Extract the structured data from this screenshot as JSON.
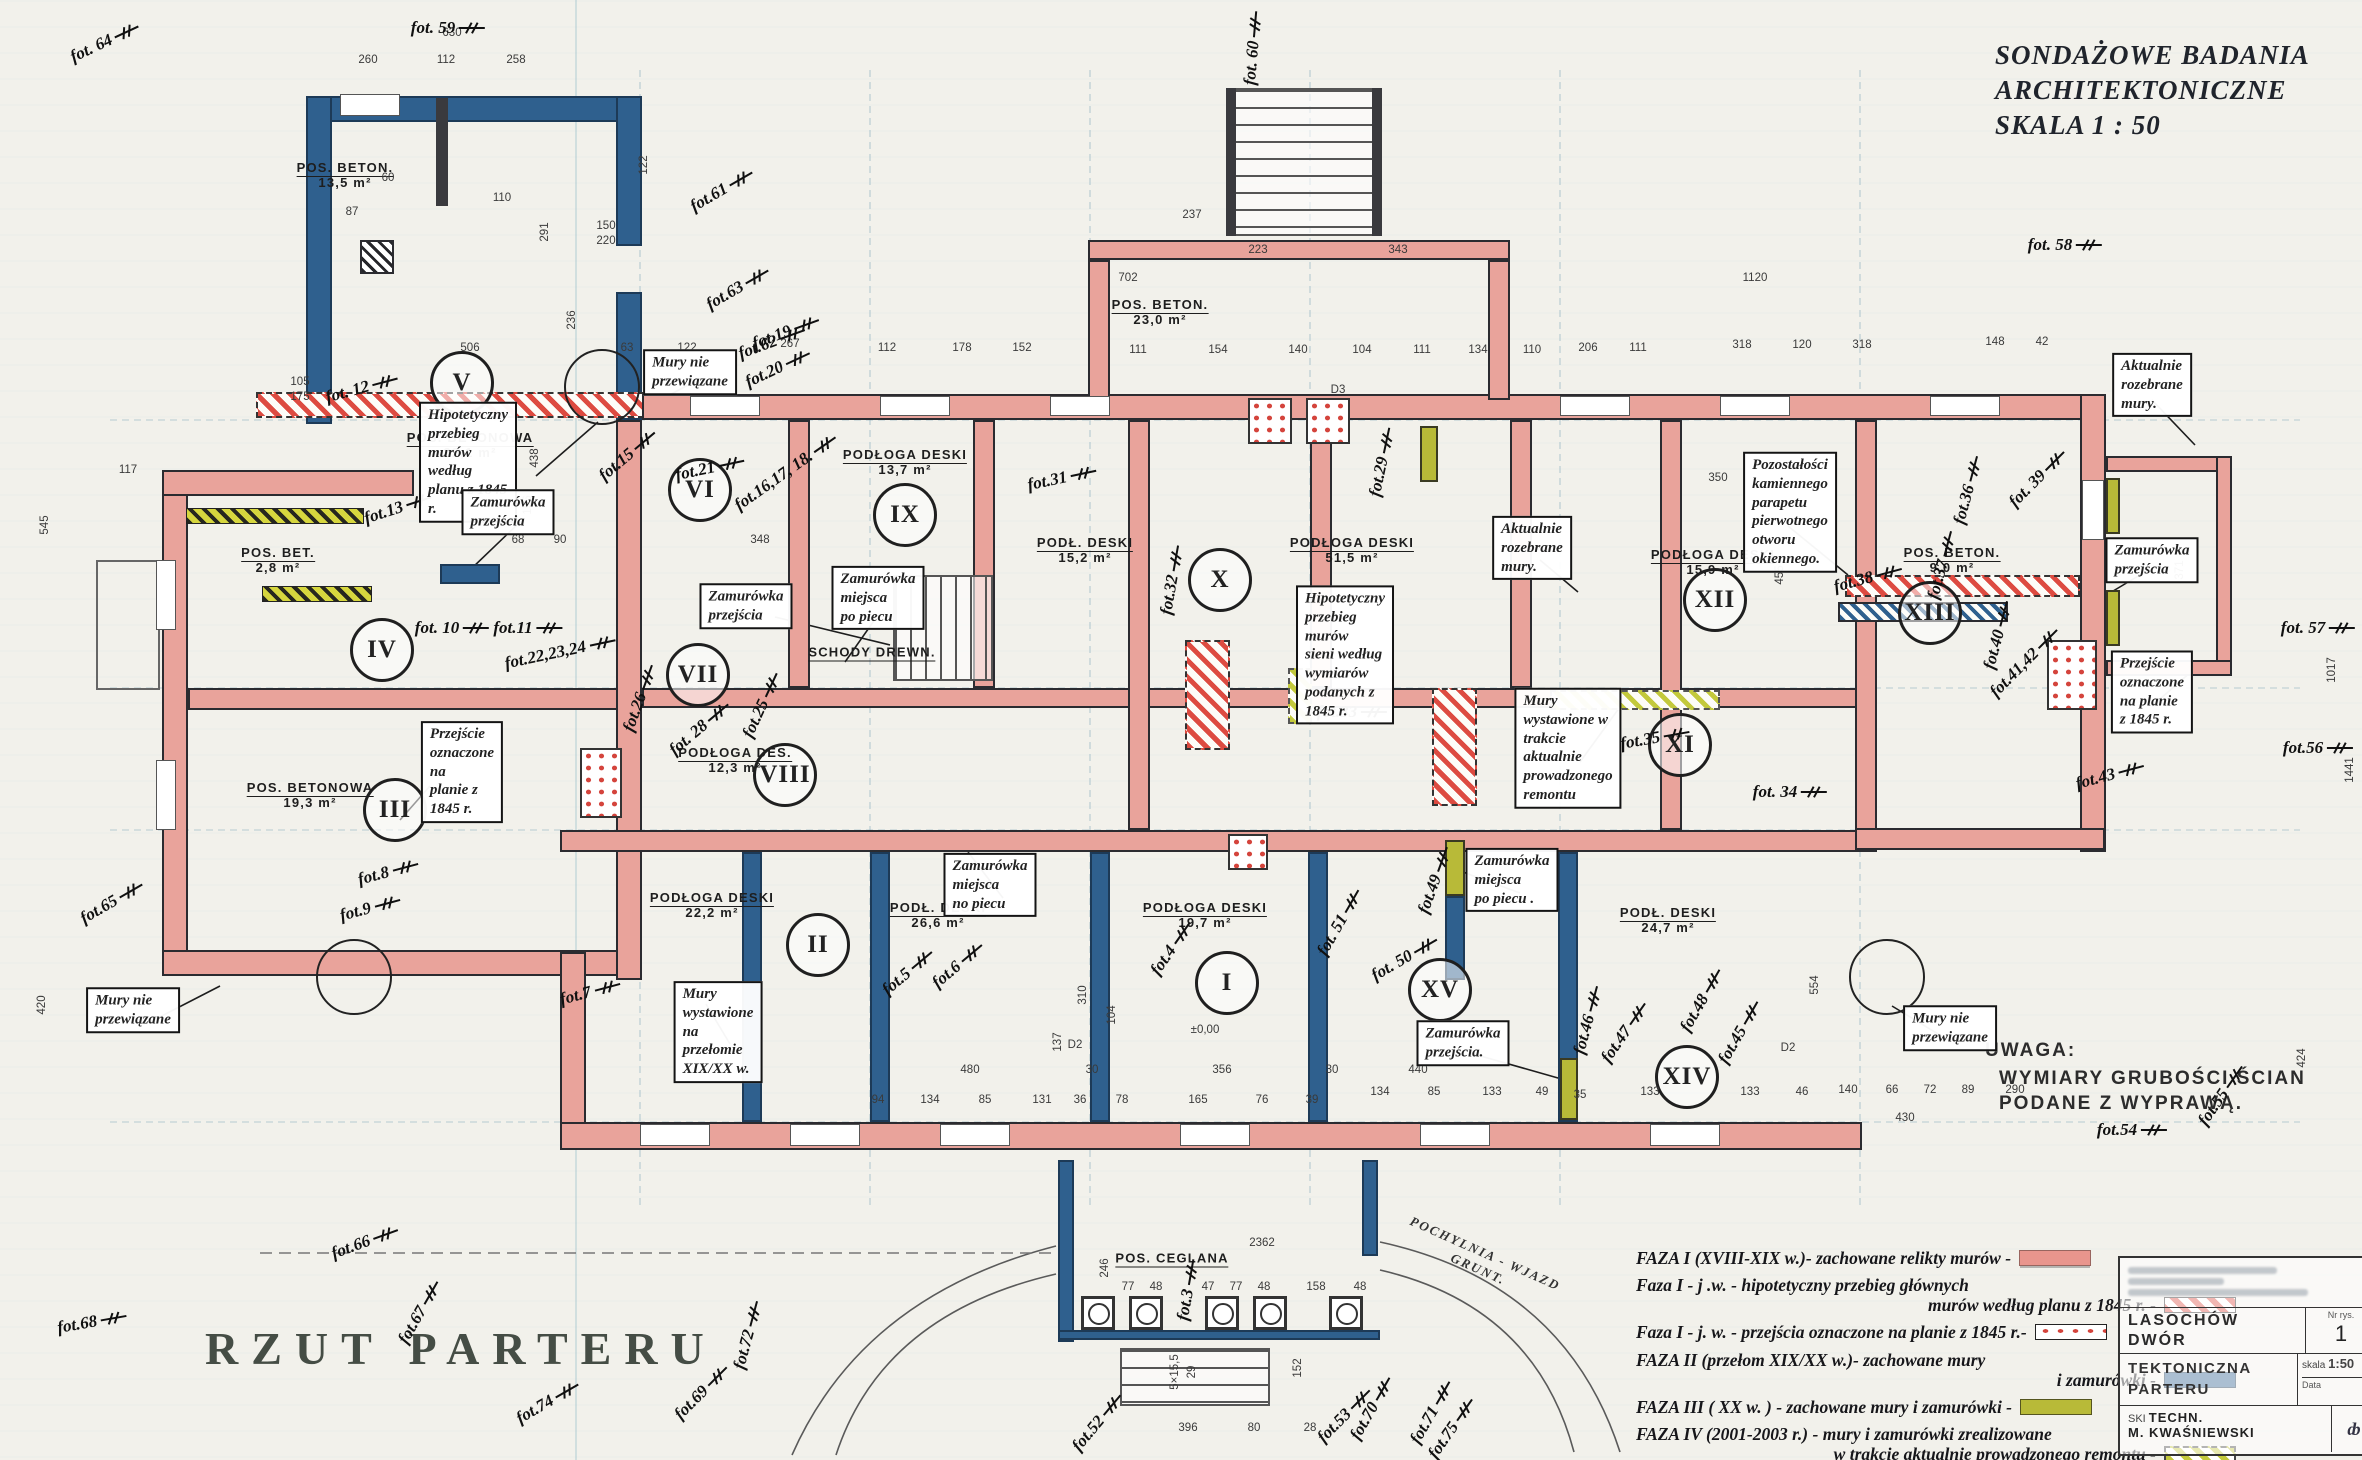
{
  "header": {
    "line1": "SONDAŻOWE  BADANIA",
    "line2": "ARCHITEKTONICZNE",
    "line3": "SKALA   1 : 50"
  },
  "drawing_title": "RZUT  PARTERU",
  "note": {
    "title": "UWAGA:",
    "line1": "WYMIARY GRUBOŚCI ŚCIAN",
    "line2": "PODANE Z WYPRAWĄ."
  },
  "arc_label": {
    "line1": "POCHYLNIA - WJAZD",
    "line2": "GRUNT."
  },
  "colors": {
    "faza1_pink": "#e9a39b",
    "faza1_hatch_red": "#dd4b41",
    "faza1_dots_red": "#d4443c",
    "faza2_blue": "#2f608e",
    "faza3_olive": "#b8ba38",
    "faza4_yellowgreen": "#c3c93c",
    "ink": "#2b2b30",
    "paper": "#f2f1eb"
  },
  "legend": {
    "items": [
      {
        "lines": [
          "FAZA I  (XVIII-XIX w.)- zachowane relikty murów -"
        ],
        "swatch": "sw-f1",
        "name": "faza-1"
      },
      {
        "lines": [
          "Faza I  -  j .w.  -  hipotetyczny  przebieg  głównych",
          "murów  według   planu  z 1845 r. -"
        ],
        "swatch": "sw-f1h",
        "name": "faza-1-hipotetyczny"
      },
      {
        "lines": [
          "Faza I - j. w. - przejścia oznaczone na planie z 1845 r.-"
        ],
        "swatch": "sw-f1d",
        "name": "faza-1-przejscia"
      },
      {
        "lines": [
          "FAZA II (przełom XIX/XX w.)- zachowane mury",
          "i  zamurówki -"
        ],
        "swatch": "sw-f2",
        "name": "faza-2"
      },
      {
        "lines": [
          "FAZA III ( XX w. ) - zachowane mury  i zamurówki -"
        ],
        "swatch": "sw-f3",
        "name": "faza-3"
      },
      {
        "lines": [
          "FAZA IV (2001-2003 r.) - mury i zamurówki zrealizowane",
          "w  trakcie  aktualnie prowadzonego remontu  -"
        ],
        "swatch": "sw-f4",
        "name": "faza-4"
      },
      {
        "lines": [
          "Faza - j. w - rozbiórki w trakcie  realizowanego remontu  -"
        ],
        "swatch": "sw-rz",
        "name": "faza-rozbiorki"
      }
    ]
  },
  "rooms": [
    {
      "numeral": "I",
      "x": 1227,
      "y": 983
    },
    {
      "numeral": "II",
      "x": 818,
      "y": 945
    },
    {
      "numeral": "III",
      "x": 395,
      "y": 810
    },
    {
      "numeral": "IV",
      "x": 382,
      "y": 650
    },
    {
      "numeral": "V",
      "x": 462,
      "y": 383
    },
    {
      "numeral": "VI",
      "x": 700,
      "y": 490
    },
    {
      "numeral": "VII",
      "x": 698,
      "y": 675
    },
    {
      "numeral": "VIII",
      "x": 785,
      "y": 775
    },
    {
      "numeral": "IX",
      "x": 905,
      "y": 515
    },
    {
      "numeral": "X",
      "x": 1220,
      "y": 580
    },
    {
      "numeral": "XI",
      "x": 1680,
      "y": 745
    },
    {
      "numeral": "XII",
      "x": 1715,
      "y": 600
    },
    {
      "numeral": "XIII",
      "x": 1930,
      "y": 613
    },
    {
      "numeral": "XIV",
      "x": 1687,
      "y": 1077
    },
    {
      "numeral": "XV",
      "x": 1440,
      "y": 990
    }
  ],
  "floor_labels": [
    {
      "t": "POS. BETON.",
      "a": "13,5 m²",
      "x": 345,
      "y": 175
    },
    {
      "t": "POS. BETONOWA",
      "a": "22,1 m²",
      "x": 470,
      "y": 445
    },
    {
      "t": "POS. BET.",
      "a": "2,8 m²",
      "x": 278,
      "y": 560
    },
    {
      "t": "POS. BETONOWA",
      "a": "19,3 m²",
      "x": 310,
      "y": 795
    },
    {
      "t": "POS. BETON.",
      "a": "23,0 m²",
      "x": 1160,
      "y": 312
    },
    {
      "t": "PODŁOGA DESKI",
      "a": "13,7 m²",
      "x": 905,
      "y": 462
    },
    {
      "t": "PODŁ. DESKI",
      "a": "15,2 m²",
      "x": 1085,
      "y": 550
    },
    {
      "t": "PODŁOGA DESKI",
      "a": "51,5 m²",
      "x": 1352,
      "y": 550
    },
    {
      "t": "PODŁOGA DESKI",
      "a": "15,9 m²",
      "x": 1713,
      "y": 562
    },
    {
      "t": "POS. BETON.",
      "a": "9,0 m²",
      "x": 1952,
      "y": 560
    },
    {
      "t": "PODŁOGA DES.",
      "a": "12,3 m²",
      "x": 735,
      "y": 760
    },
    {
      "t": "SCHODY DREWN.",
      "a": "",
      "x": 872,
      "y": 652
    },
    {
      "t": "PODŁOGA DESKI",
      "a": "22,2 m²",
      "x": 712,
      "y": 905
    },
    {
      "t": "PODŁ. DESKI",
      "a": "26,6 m²",
      "x": 938,
      "y": 915
    },
    {
      "t": "PODŁOGA DESKI",
      "a": "19,7 m²",
      "x": 1205,
      "y": 915
    },
    {
      "t": "PODŁ. DESKI",
      "a": "24,7 m²",
      "x": 1668,
      "y": 920
    },
    {
      "t": "POS. CEGLANA",
      "a": "",
      "x": 1172,
      "y": 1258
    }
  ],
  "annotations": [
    {
      "text": "Mury nie przewiązane",
      "x": 690,
      "y": 372
    },
    {
      "text": "Hipotetyczny przebieg murów\nwedług planu z 1845 r.",
      "x": 468,
      "y": 462
    },
    {
      "text": "Zamurówka przejścia",
      "x": 508,
      "y": 512
    },
    {
      "text": "Zamurówka\nprzejścia",
      "x": 746,
      "y": 606
    },
    {
      "text": "Zamurówka miejsca\npo piecu",
      "x": 878,
      "y": 598
    },
    {
      "text": "Przejście oznaczone na\nplanie z 1845 r.",
      "x": 462,
      "y": 772
    },
    {
      "text": "Mury wystawione\nna przełomie XIX/XX w.",
      "x": 718,
      "y": 1032
    },
    {
      "text": "Zamurówka miejsca\nno piecu",
      "x": 990,
      "y": 885
    },
    {
      "text": "Hipotetyczny przebieg murów\nsieni według wymiarów\npodanych z 1845 r.",
      "x": 1345,
      "y": 655
    },
    {
      "text": "Aktualnie rozebrane\nmury.",
      "x": 1532,
      "y": 548
    },
    {
      "text": "Pozostałości kamiennego parapetu\npierwotnego otworu okiennego.",
      "x": 1790,
      "y": 512
    },
    {
      "text": "Mury wystawione w trakcie\naktualnie prowadzonego remontu",
      "x": 1568,
      "y": 748
    },
    {
      "text": "Zamurówka miejsca\npo piecu .",
      "x": 1512,
      "y": 880
    },
    {
      "text": "Zamurówka przejścia.",
      "x": 1463,
      "y": 1043
    },
    {
      "text": "Zamurówka przejścia",
      "x": 2152,
      "y": 560
    },
    {
      "text": "Przejście oznaczone\nna planie z 1845 r.",
      "x": 2152,
      "y": 692
    },
    {
      "text": "Mury nie przewiązane",
      "x": 133,
      "y": 1010
    },
    {
      "text": "Mury nie przewiązane",
      "x": 1950,
      "y": 1028
    },
    {
      "text": "Aktualnie rozebrane\nmury.",
      "x": 2152,
      "y": 385
    }
  ],
  "photo_markers": [
    {
      "l": "fot. 64",
      "x": 105,
      "y": 42,
      "r": -25
    },
    {
      "l": "fot. 59",
      "x": 448,
      "y": 28,
      "r": 0
    },
    {
      "l": "fot.61",
      "x": 722,
      "y": 190,
      "r": -30
    },
    {
      "l": "fot.63",
      "x": 738,
      "y": 288,
      "r": -30
    },
    {
      "l": "fot.62",
      "x": 772,
      "y": 342,
      "r": -20
    },
    {
      "l": "fot. 60",
      "x": 1253,
      "y": 48,
      "r": -85
    },
    {
      "l": "fot. 58",
      "x": 2065,
      "y": 245,
      "r": 0
    },
    {
      "l": "fot. 12",
      "x": 362,
      "y": 388,
      "r": -15
    },
    {
      "l": "fot.13",
      "x": 398,
      "y": 508,
      "r": -18
    },
    {
      "l": "fot. 10",
      "x": 452,
      "y": 628,
      "r": 0
    },
    {
      "l": "fot.11",
      "x": 528,
      "y": 628,
      "r": 0
    },
    {
      "l": "fot.22,23,24",
      "x": 560,
      "y": 652,
      "r": -12
    },
    {
      "l": "fot.26",
      "x": 640,
      "y": 698,
      "r": -70
    },
    {
      "l": "fot. 28",
      "x": 700,
      "y": 728,
      "r": -40
    },
    {
      "l": "fot.25",
      "x": 762,
      "y": 705,
      "r": -65
    },
    {
      "l": "fot.15",
      "x": 628,
      "y": 455,
      "r": -40
    },
    {
      "l": "fot.21",
      "x": 710,
      "y": 468,
      "r": -12
    },
    {
      "l": "fot.16,17, 18.",
      "x": 786,
      "y": 472,
      "r": -35
    },
    {
      "l": "fot.19",
      "x": 786,
      "y": 332,
      "r": -20
    },
    {
      "l": "fot.20",
      "x": 778,
      "y": 368,
      "r": -25
    },
    {
      "l": "fot.31",
      "x": 1062,
      "y": 478,
      "r": -12
    },
    {
      "l": "fot.32",
      "x": 1172,
      "y": 580,
      "r": -80
    },
    {
      "l": "fot.29",
      "x": 1382,
      "y": 462,
      "r": -78
    },
    {
      "l": "fot.33",
      "x": 1352,
      "y": 712,
      "r": 0
    },
    {
      "l": "fot. 34",
      "x": 1790,
      "y": 792,
      "r": 0
    },
    {
      "l": "fot.35",
      "x": 1655,
      "y": 738,
      "r": -10
    },
    {
      "l": "fot.36",
      "x": 1968,
      "y": 490,
      "r": -75
    },
    {
      "l": "fot.37",
      "x": 1942,
      "y": 565,
      "r": -75
    },
    {
      "l": "fot.38",
      "x": 1868,
      "y": 578,
      "r": -15
    },
    {
      "l": "fot. 39",
      "x": 2038,
      "y": 478,
      "r": -45
    },
    {
      "l": "fot.40",
      "x": 1998,
      "y": 635,
      "r": -75
    },
    {
      "l": "fot.41,42",
      "x": 2025,
      "y": 662,
      "r": -45
    },
    {
      "l": "fot.43",
      "x": 2110,
      "y": 775,
      "r": -15
    },
    {
      "l": "fot.45",
      "x": 1740,
      "y": 1032,
      "r": -60
    },
    {
      "l": "fot.48",
      "x": 1702,
      "y": 1000,
      "r": -60
    },
    {
      "l": "fot.46",
      "x": 1588,
      "y": 1020,
      "r": -75
    },
    {
      "l": "fot.47",
      "x": 1625,
      "y": 1032,
      "r": -55
    },
    {
      "l": "fot.49",
      "x": 1435,
      "y": 880,
      "r": -70
    },
    {
      "l": "fot. 50",
      "x": 1405,
      "y": 958,
      "r": -30
    },
    {
      "l": "fot. 51",
      "x": 1340,
      "y": 922,
      "r": -60
    },
    {
      "l": "fot.4",
      "x": 1172,
      "y": 948,
      "r": -55
    },
    {
      "l": "fot.5",
      "x": 908,
      "y": 972,
      "r": -40
    },
    {
      "l": "fot.6",
      "x": 958,
      "y": 965,
      "r": -40
    },
    {
      "l": "fot.7",
      "x": 590,
      "y": 992,
      "r": -15
    },
    {
      "l": "fot.8",
      "x": 388,
      "y": 872,
      "r": -15
    },
    {
      "l": "fot.9",
      "x": 370,
      "y": 908,
      "r": -15
    },
    {
      "l": "fot.65",
      "x": 112,
      "y": 902,
      "r": -30
    },
    {
      "l": "fot.66",
      "x": 365,
      "y": 1242,
      "r": -20
    },
    {
      "l": "fot.68",
      "x": 92,
      "y": 1322,
      "r": -10
    },
    {
      "l": "fot.67",
      "x": 420,
      "y": 1312,
      "r": -60
    },
    {
      "l": "fot.74",
      "x": 548,
      "y": 1402,
      "r": -30
    },
    {
      "l": "fot.69",
      "x": 702,
      "y": 1392,
      "r": -45
    },
    {
      "l": "fot.72",
      "x": 748,
      "y": 1335,
      "r": -75
    },
    {
      "l": "fot.52",
      "x": 1098,
      "y": 1422,
      "r": -50
    },
    {
      "l": "fot.53",
      "x": 1345,
      "y": 1415,
      "r": -45
    },
    {
      "l": "fot.75",
      "x": 1452,
      "y": 1428,
      "r": -55
    },
    {
      "l": "fot.70",
      "x": 1372,
      "y": 1408,
      "r": -60
    },
    {
      "l": "fot.71",
      "x": 1432,
      "y": 1412,
      "r": -60
    },
    {
      "l": "fot.3",
      "x": 1188,
      "y": 1290,
      "r": -80
    },
    {
      "l": "fot.54",
      "x": 2132,
      "y": 1130,
      "r": 0
    },
    {
      "l": "fot.55",
      "x": 2222,
      "y": 1095,
      "r": -55
    },
    {
      "l": "fot.56",
      "x": 2318,
      "y": 748,
      "r": 0
    },
    {
      "l": "fot. 57",
      "x": 2318,
      "y": 628,
      "r": 0
    }
  ],
  "dimensions": [
    {
      "t": "630",
      "x": 452,
      "y": 33
    },
    {
      "t": "260",
      "x": 368,
      "y": 60
    },
    {
      "t": "112",
      "x": 446,
      "y": 60
    },
    {
      "t": "258",
      "x": 516,
      "y": 60
    },
    {
      "t": "506",
      "x": 470,
      "y": 348
    },
    {
      "t": "236",
      "x": 572,
      "y": 320,
      "r": -90
    },
    {
      "t": "63",
      "x": 627,
      "y": 348
    },
    {
      "t": "122",
      "x": 687,
      "y": 348
    },
    {
      "t": "267",
      "x": 790,
      "y": 344
    },
    {
      "t": "112",
      "x": 887,
      "y": 348
    },
    {
      "t": "178",
      "x": 962,
      "y": 348
    },
    {
      "t": "152",
      "x": 1022,
      "y": 348
    },
    {
      "t": "111",
      "x": 1138,
      "y": 350
    },
    {
      "t": "154",
      "x": 1218,
      "y": 350
    },
    {
      "t": "140",
      "x": 1298,
      "y": 350
    },
    {
      "t": "104",
      "x": 1362,
      "y": 350
    },
    {
      "t": "111",
      "x": 1422,
      "y": 350
    },
    {
      "t": "134",
      "x": 1478,
      "y": 350
    },
    {
      "t": "110",
      "x": 1532,
      "y": 350
    },
    {
      "t": "206",
      "x": 1588,
      "y": 348
    },
    {
      "t": "111",
      "x": 1638,
      "y": 348
    },
    {
      "t": "318",
      "x": 1742,
      "y": 345
    },
    {
      "t": "120",
      "x": 1802,
      "y": 345
    },
    {
      "t": "318",
      "x": 1862,
      "y": 345
    },
    {
      "t": "148",
      "x": 1995,
      "y": 342
    },
    {
      "t": "42",
      "x": 2042,
      "y": 342
    },
    {
      "t": "1120",
      "x": 1755,
      "y": 278
    },
    {
      "t": "702",
      "x": 1128,
      "y": 278
    },
    {
      "t": "237",
      "x": 1192,
      "y": 215
    },
    {
      "t": "223",
      "x": 1258,
      "y": 250
    },
    {
      "t": "343",
      "x": 1398,
      "y": 250
    },
    {
      "t": "110",
      "x": 502,
      "y": 198
    },
    {
      "t": "60",
      "x": 388,
      "y": 178
    },
    {
      "t": "87",
      "x": 352,
      "y": 212
    },
    {
      "t": "291",
      "x": 545,
      "y": 232,
      "r": -90
    },
    {
      "t": "122",
      "x": 644,
      "y": 165,
      "r": -90
    },
    {
      "t": "150",
      "x": 606,
      "y": 226
    },
    {
      "t": "220",
      "x": 606,
      "y": 241
    },
    {
      "t": "545",
      "x": 45,
      "y": 525,
      "r": -90
    },
    {
      "t": "420",
      "x": 42,
      "y": 1005,
      "r": -90
    },
    {
      "t": "117",
      "x": 128,
      "y": 470
    },
    {
      "t": "105",
      "x": 300,
      "y": 382
    },
    {
      "t": "175",
      "x": 300,
      "y": 397
    },
    {
      "t": "438",
      "x": 535,
      "y": 458,
      "r": -90
    },
    {
      "t": "156",
      "x": 528,
      "y": 505,
      "r": -90
    },
    {
      "t": "68",
      "x": 518,
      "y": 540
    },
    {
      "t": "90",
      "x": 560,
      "y": 540
    },
    {
      "t": "348",
      "x": 760,
      "y": 540
    },
    {
      "t": "350",
      "x": 1718,
      "y": 478
    },
    {
      "t": "455",
      "x": 1780,
      "y": 575,
      "r": -90
    },
    {
      "t": "371",
      "x": 2180,
      "y": 570,
      "r": -90
    },
    {
      "t": "554",
      "x": 1815,
      "y": 985,
      "r": -90
    },
    {
      "t": "1017",
      "x": 2332,
      "y": 670,
      "r": -90
    },
    {
      "t": "1441",
      "x": 2350,
      "y": 770,
      "r": -90
    },
    {
      "t": "424",
      "x": 2302,
      "y": 1058,
      "r": -90
    },
    {
      "t": "94",
      "x": 878,
      "y": 1100
    },
    {
      "t": "134",
      "x": 930,
      "y": 1100
    },
    {
      "t": "85",
      "x": 985,
      "y": 1100
    },
    {
      "t": "131",
      "x": 1042,
      "y": 1100
    },
    {
      "t": "36",
      "x": 1080,
      "y": 1100
    },
    {
      "t": "78",
      "x": 1122,
      "y": 1100
    },
    {
      "t": "165",
      "x": 1198,
      "y": 1100
    },
    {
      "t": "76",
      "x": 1262,
      "y": 1100
    },
    {
      "t": "39",
      "x": 1312,
      "y": 1100
    },
    {
      "t": "480",
      "x": 970,
      "y": 1070
    },
    {
      "t": "356",
      "x": 1222,
      "y": 1070
    },
    {
      "t": "30",
      "x": 1092,
      "y": 1070
    },
    {
      "t": "30",
      "x": 1332,
      "y": 1070
    },
    {
      "t": "±0,00",
      "x": 1205,
      "y": 1030
    },
    {
      "t": "D2",
      "x": 1075,
      "y": 1045
    },
    {
      "t": "D2",
      "x": 1788,
      "y": 1048
    },
    {
      "t": "D3",
      "x": 1338,
      "y": 390
    },
    {
      "t": "310",
      "x": 1083,
      "y": 995,
      "r": -90
    },
    {
      "t": "137",
      "x": 1058,
      "y": 1042,
      "r": -90
    },
    {
      "t": "104",
      "x": 1112,
      "y": 1015,
      "r": -90
    },
    {
      "t": "440",
      "x": 1418,
      "y": 1070
    },
    {
      "t": "134",
      "x": 1380,
      "y": 1092
    },
    {
      "t": "85",
      "x": 1434,
      "y": 1092
    },
    {
      "t": "133",
      "x": 1492,
      "y": 1092
    },
    {
      "t": "49",
      "x": 1542,
      "y": 1092
    },
    {
      "t": "35",
      "x": 1580,
      "y": 1095
    },
    {
      "t": "133",
      "x": 1650,
      "y": 1092
    },
    {
      "t": "133",
      "x": 1750,
      "y": 1092
    },
    {
      "t": "46",
      "x": 1802,
      "y": 1092
    },
    {
      "t": "140",
      "x": 1848,
      "y": 1090
    },
    {
      "t": "66",
      "x": 1892,
      "y": 1090
    },
    {
      "t": "72",
      "x": 1930,
      "y": 1090
    },
    {
      "t": "89",
      "x": 1968,
      "y": 1090
    },
    {
      "t": "290",
      "x": 2015,
      "y": 1090
    },
    {
      "t": "430",
      "x": 1905,
      "y": 1118
    },
    {
      "t": "2362",
      "x": 1262,
      "y": 1243
    },
    {
      "t": "246",
      "x": 1105,
      "y": 1268,
      "r": -90
    },
    {
      "t": "77",
      "x": 1128,
      "y": 1287
    },
    {
      "t": "48",
      "x": 1156,
      "y": 1287
    },
    {
      "t": "47",
      "x": 1208,
      "y": 1287
    },
    {
      "t": "77",
      "x": 1236,
      "y": 1287
    },
    {
      "t": "48",
      "x": 1264,
      "y": 1287
    },
    {
      "t": "158",
      "x": 1316,
      "y": 1287
    },
    {
      "t": "48",
      "x": 1360,
      "y": 1287
    },
    {
      "t": "5×15,5",
      "x": 1175,
      "y": 1372,
      "r": -90
    },
    {
      "t": "29",
      "x": 1192,
      "y": 1372,
      "r": -90
    },
    {
      "t": "152",
      "x": 1298,
      "y": 1368,
      "r": -90
    },
    {
      "t": "396",
      "x": 1188,
      "y": 1428
    },
    {
      "t": "80",
      "x": 1254,
      "y": 1428
    },
    {
      "t": "28",
      "x": 1310,
      "y": 1428
    }
  ],
  "title_block": {
    "object_line1": "LASOCHÓW",
    "object_line2": "DWÓR",
    "subject_line1": "TEKTONICZNA",
    "subject_line2": "PARTERU",
    "nr_label": "Nr rys.",
    "nr_value": "1",
    "scale_label": "skala",
    "scale_value": "1:50",
    "date_label": "Data",
    "left_fragment": "SKI",
    "techn_label": "TECHN.",
    "techn_name": "M. KWAŚNIEWSKI"
  }
}
